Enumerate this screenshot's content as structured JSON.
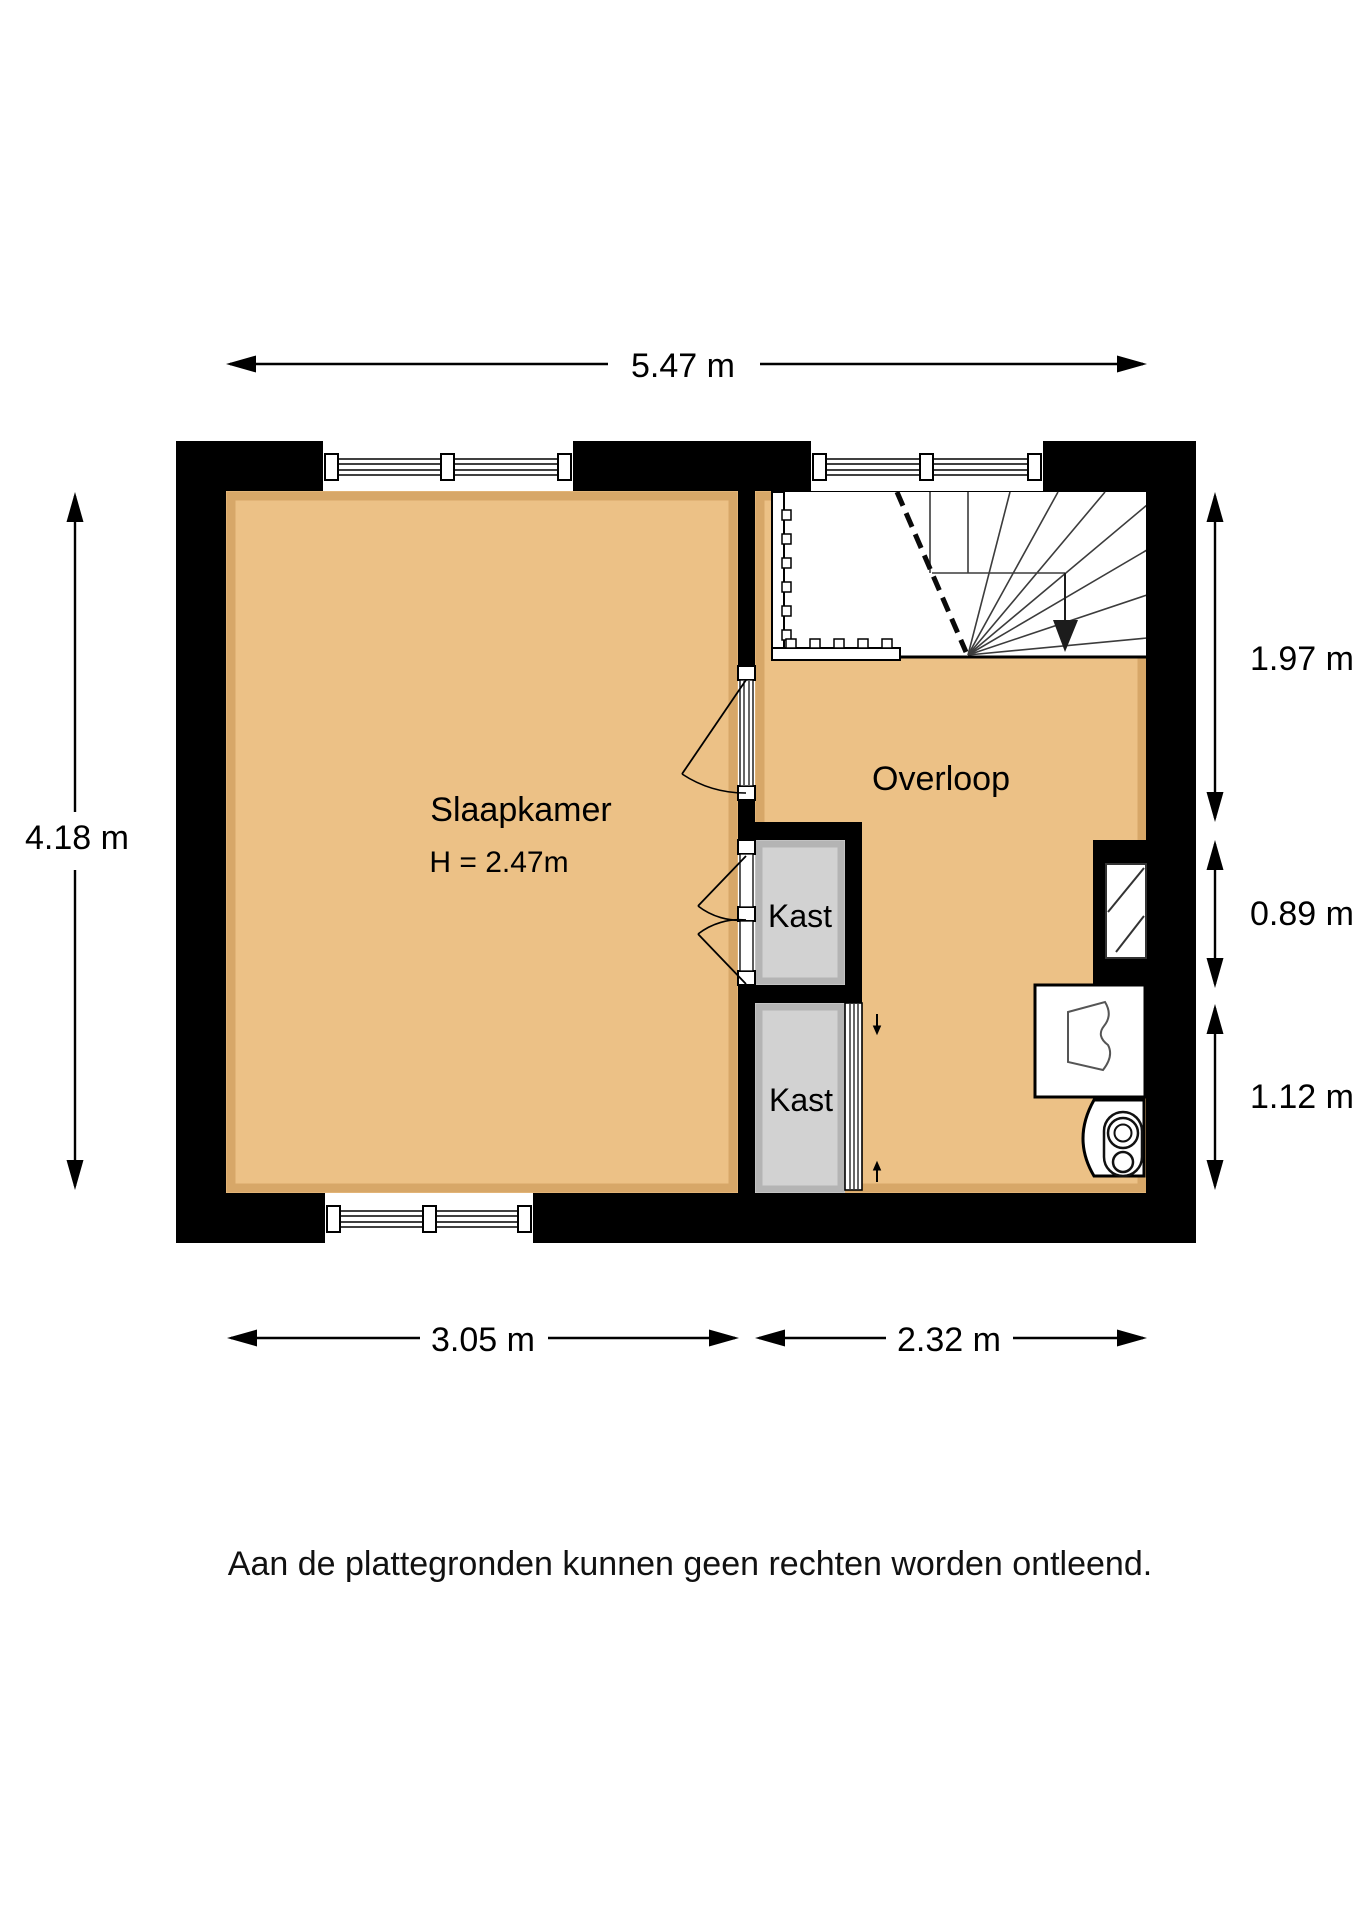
{
  "floorplan": {
    "rooms": {
      "slaapkamer": {
        "name": "Slaapkamer",
        "height_label": "H = 2.47m"
      },
      "overloop": {
        "name": "Overloop"
      },
      "kast_top": {
        "name": "Kast"
      },
      "kast_bottom": {
        "name": "Kast"
      }
    },
    "dimensions": {
      "total_width": "5.47 m",
      "total_height": "4.18 m",
      "right_top": "1.97 m",
      "right_middle": "0.89 m",
      "right_bottom": "1.12 m",
      "bottom_left": "3.05 m",
      "bottom_right": "2.32 m"
    },
    "disclaimer": "Aan de plattegronden kunnen geen rechten worden ontleend.",
    "colors": {
      "floor": "#ecc186",
      "closet": "#d2d2d2",
      "wall": "#000000",
      "stair_line": "#3c3c3c"
    }
  }
}
